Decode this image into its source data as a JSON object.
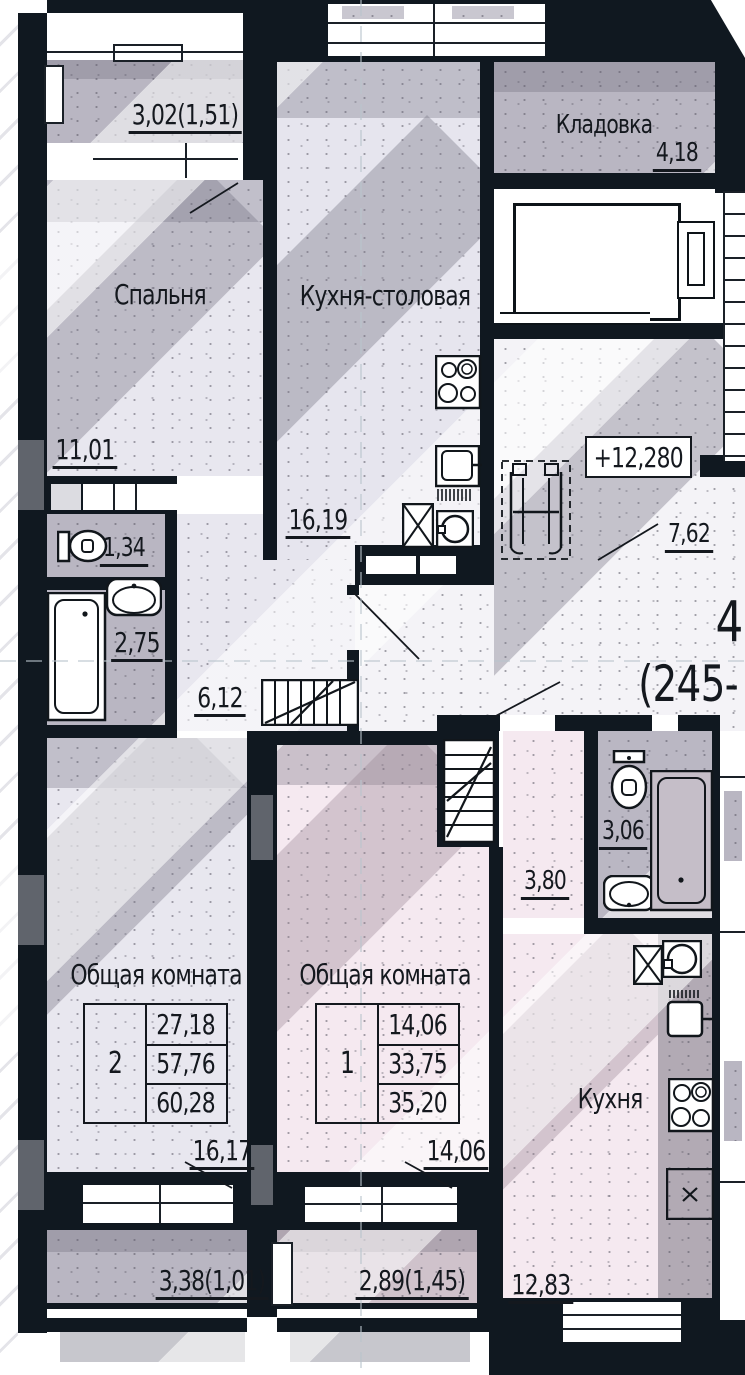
{
  "drawing": {
    "rooms": {
      "bedroom": {
        "name": "Спальня",
        "area": "11,01"
      },
      "kitchen_dining": {
        "name": "Кухня-столовая",
        "area": "16,19"
      },
      "storage": {
        "name": "Кладовка",
        "area": "4,18"
      },
      "wc": {
        "area": "1,34"
      },
      "bathroom": {
        "area": "2,75"
      },
      "corridor": {
        "area": "6,12"
      },
      "lobby": {
        "area": "7,62"
      },
      "living_apt2": {
        "name": "Общая комната",
        "area": "16,17"
      },
      "living_apt1": {
        "name": "Общая комната",
        "area": "14,06"
      },
      "bathroom_apt1": {
        "area": "3,06"
      },
      "hall_apt1": {
        "area": "3,80"
      },
      "kitchen_apt1": {
        "name": "Кухня",
        "area": "12,83"
      },
      "balcony_top": {
        "area": "3,02(1,51)"
      },
      "balcony_bottom_left": {
        "area": "3,38(1,01)"
      },
      "balcony_bottom_mid": {
        "area": "2,89(1,45)"
      }
    },
    "marks": {
      "elevation": "+12,280",
      "apartment_number": "4",
      "apartment_range": "(245-"
    },
    "tables": [
      {
        "apt": "2",
        "rows": [
          "27,18",
          "57,76",
          "60,28"
        ]
      },
      {
        "apt": "1",
        "rows": [
          "14,06",
          "33,75",
          "35,20"
        ]
      }
    ],
    "colors": {
      "wall": "#101820",
      "lavender": "#e8e7ef",
      "grey": "#b9b6c2",
      "pink": "#f5e9f0",
      "pink_grey": "#cfc2cb"
    }
  }
}
